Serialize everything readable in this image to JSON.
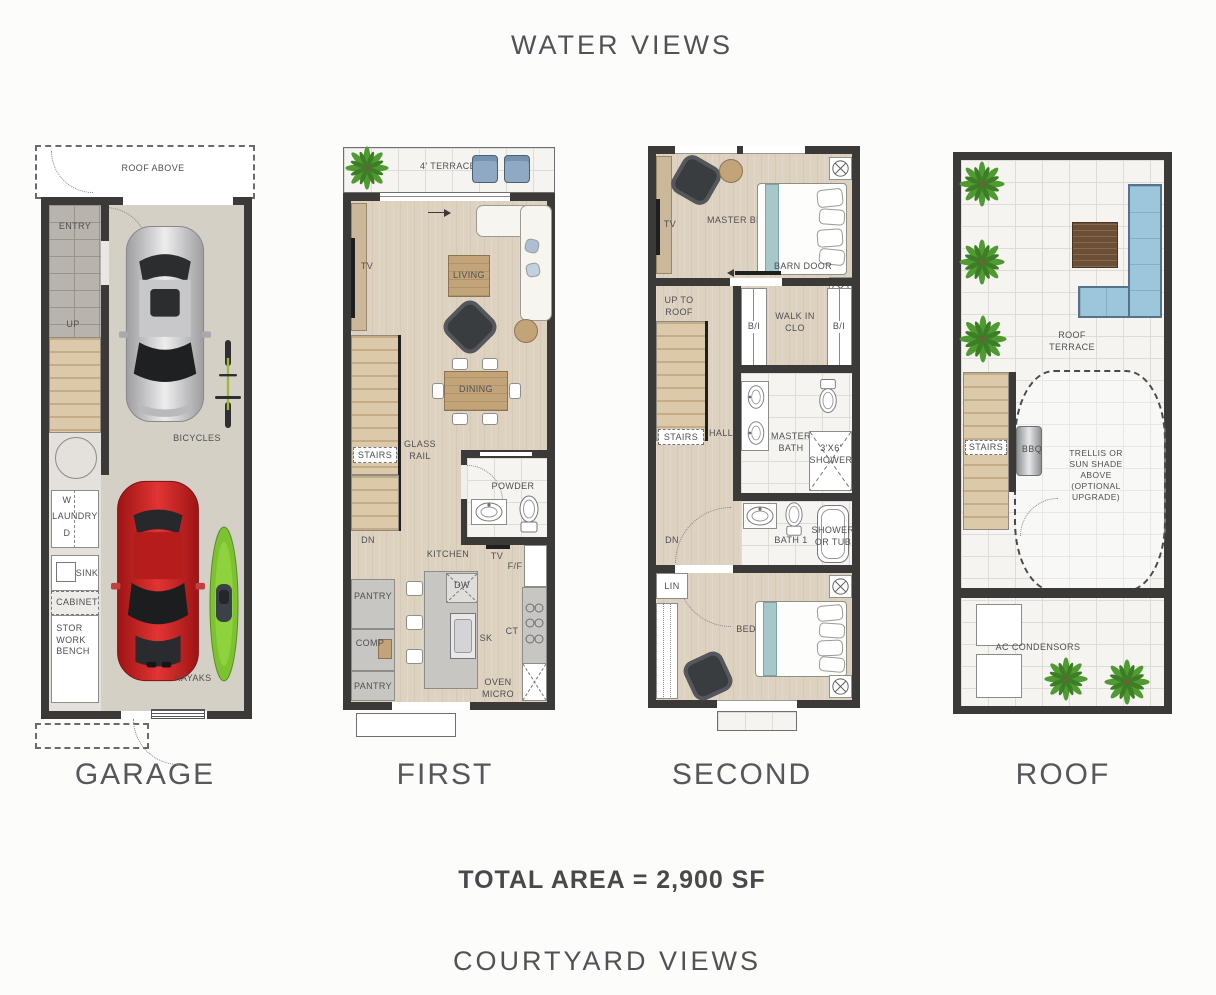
{
  "header": {
    "top_title": "WATER VIEWS"
  },
  "footer": {
    "total_area": "TOTAL AREA = 2,900 SF",
    "bottom_title": "COURTYARD  VIEWS"
  },
  "colors": {
    "wall": "#3b3a38",
    "wood_floor": "#ddd1c0",
    "garage_floor": "#d5d0c6",
    "tile": "#f5f4f1",
    "stair_wood": "#dcc9a9",
    "teal_bed_runner": "#a6c8ca",
    "roof_sofa_blue": "#9cc6dc",
    "terrace_chair_blue": "#8fa8c4",
    "car_red": "#c92222",
    "car_silver": "#c6c6c8",
    "kayak_green": "#7dc331",
    "plant_green": "#4f9b31",
    "label_text": "#4e4f52"
  },
  "floors": {
    "garage": {
      "title": "GARAGE",
      "labels": {
        "roof_above": "ROOF ABOVE",
        "entry": "ENTRY",
        "up": "UP",
        "bicycles": "BICYCLES",
        "w": "W",
        "laundry": "LAUNDRY",
        "d": "D",
        "sink": "SINK",
        "cabinet": "CABINET",
        "stor_bench": "STOR\nWORK\nBENCH",
        "kayaks": "KAYAKS"
      }
    },
    "first": {
      "title": "FIRST",
      "labels": {
        "terrace": "4' TERRACE",
        "tv": "TV",
        "living": "LIVING",
        "dining": "DINING",
        "stairs": "STAIRS",
        "glass_rail": "GLASS\nRAIL",
        "dn": "DN",
        "powder": "POWDER",
        "kitchen": "KITCHEN",
        "tv2": "TV",
        "ff": "F/F",
        "pantry1": "PANTRY",
        "comp": "COMP",
        "pantry2": "PANTRY",
        "dw": "DW",
        "sk": "SK",
        "ct": "CT",
        "oven": "OVEN\nMICRO"
      }
    },
    "second": {
      "title": "SECOND",
      "labels": {
        "master_bedroom": "MASTER BEDROOM",
        "tv": "TV",
        "barn_door": "BARN DOOR",
        "up_to_roof": "UP TO\nROOF",
        "bi_left": "B/I",
        "walk_in": "WALK IN\nCLO",
        "bi_right": "B/I",
        "stairs": "STAIRS",
        "hall": "HALL",
        "master_bath": "MASTER\nBATH",
        "shower36": "3'X6'\nSHOWER",
        "dn": "DN",
        "lin": "LIN",
        "bath1": "BATH 1",
        "shower_tub": "SHOWER\nOR TUB",
        "bedroom1": "BEDROOM 1"
      }
    },
    "roof": {
      "title": "ROOF",
      "labels": {
        "roof_terrace": "ROOF\nTERRACE",
        "stairs": "STAIRS",
        "bbq": "BBQ",
        "trellis": "TRELLIS OR\nSUN SHADE ABOVE\n(OPTIONAL UPGRADE)",
        "ac": "AC CONDENSORS"
      }
    }
  }
}
